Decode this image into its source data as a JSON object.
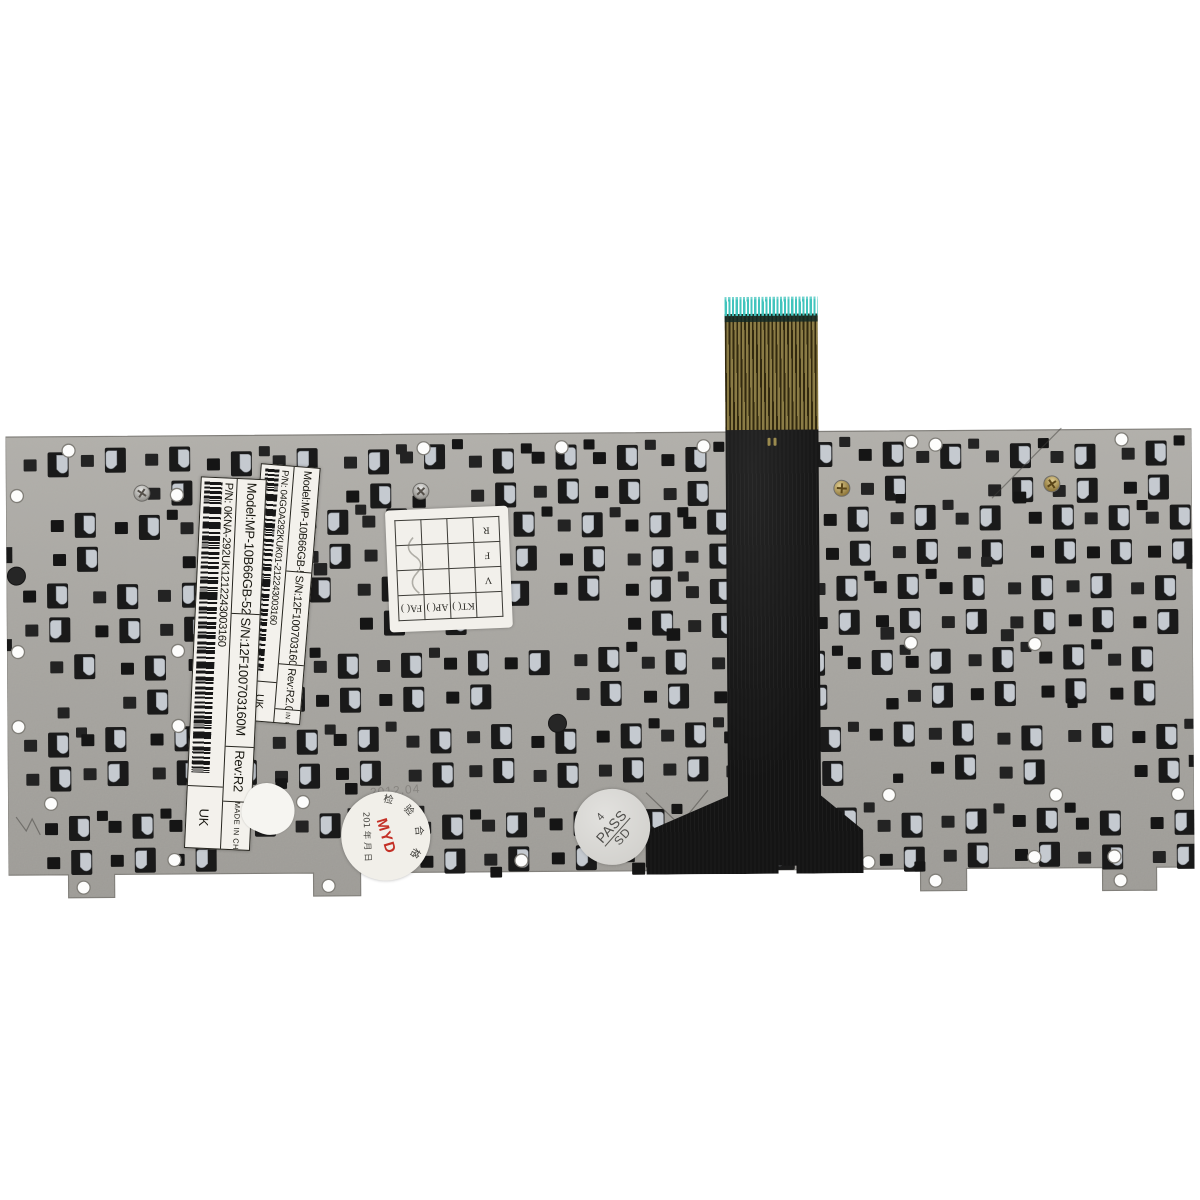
{
  "labels": {
    "upper": {
      "model": "Model:MP-10B66GB-5288",
      "serial": "S/N:12F100703160M",
      "revision": "Rev:R2.0",
      "part_number": "P/N:  04GOA292KUK01-212243003160",
      "region": "UK",
      "made_in": "MADE IN CHINA"
    },
    "lower": {
      "model": "Model:MP-10B66GB-5288",
      "serial": "S/N:12F100703160M",
      "revision": "Rev:R2",
      "part_number": "P/N:  0KNA-292UK1212243003160",
      "region": "UK",
      "made_in": "MADE IN CH"
    }
  },
  "qc_grid": {
    "header_row": [
      "",
      "KT( )",
      "AP( )",
      "FA( )"
    ],
    "row_labels": [
      "V",
      "F",
      "R"
    ]
  },
  "round_stamp": {
    "arc_text": "检 验 合 格",
    "date_line": "201   年  月  日",
    "code": "MYD"
  },
  "pass_stamp": {
    "digit": "4",
    "word": "PASS",
    "initials": "SD"
  },
  "etched_date": "2012.04",
  "colors": {
    "background": "#ffffff",
    "plate": "#a7a5a0",
    "plate_dark": "#9a9893",
    "cutout": "#1a1a1a",
    "tab_highlight": "#c5cad0",
    "ribbon_black": "#141414",
    "connector_gold": "#8b7c46",
    "connector_teal": "#41c4bd",
    "sticker_white": "#f3f1ec",
    "stamp_red": "#c43026"
  }
}
